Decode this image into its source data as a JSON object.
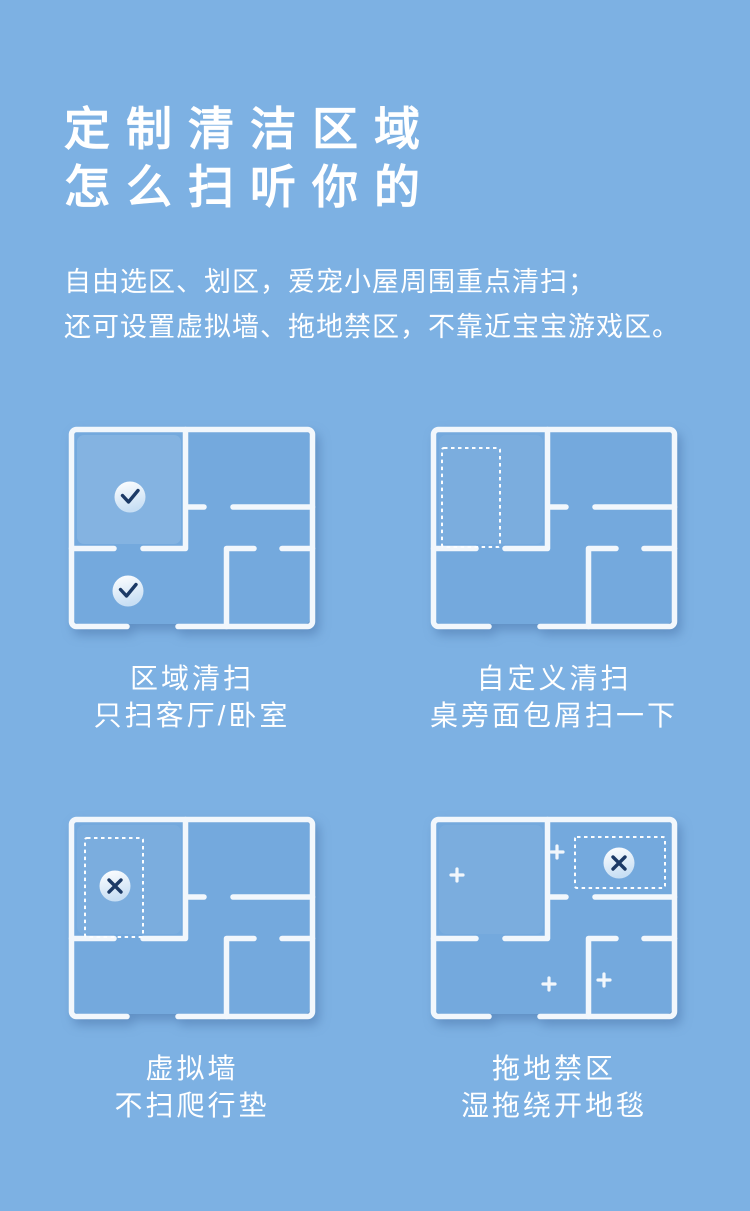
{
  "page": {
    "background_color": "#7DB1E3",
    "heading": {
      "line1": "定制清洁区域",
      "line2": "怎么扫听你的"
    },
    "subtitle": {
      "line1": "自由选区、划区，爱宠小屋周围重点清扫；",
      "line2": "还可设置虚拟墙、拖地禁区，不靠近宝宝游戏区。"
    }
  },
  "features": [
    {
      "title": "区域清扫",
      "desc": "只扫客厅/卧室",
      "diagram": {
        "type": "floorplan",
        "marks": [
          "check-icon",
          "check-icon"
        ],
        "note": "two rooms checked for zone cleaning"
      }
    },
    {
      "title": "自定义清扫",
      "desc": "桌旁面包屑扫一下",
      "diagram": {
        "type": "floorplan",
        "marks": [
          "dashed-zone-rect"
        ],
        "note": "custom cleaning zone drawn in top-left room"
      }
    },
    {
      "title": "虚拟墙",
      "desc": "不扫爬行垫",
      "diagram": {
        "type": "floorplan",
        "marks": [
          "dashed-zone-rect",
          "cross-icon"
        ],
        "note": "virtual wall no-go zone around crawling mat"
      }
    },
    {
      "title": "拖地禁区",
      "desc": "湿拖绕开地毯",
      "diagram": {
        "type": "floorplan",
        "marks": [
          "dashed-zone-rect",
          "cross-icon",
          "plus-icon",
          "plus-icon",
          "plus-icon",
          "plus-icon"
        ],
        "note": "no-mop zone over carpet, plus marks elsewhere"
      }
    }
  ],
  "colors": {
    "background": "#7DB1E3",
    "floor": "#74A9DD",
    "wall": "#F2F7FC",
    "mark": "#1C3A66",
    "text": "#FFFFFF",
    "circle_top": "#FFFFFF",
    "circle_bottom": "#C8DFF4"
  }
}
